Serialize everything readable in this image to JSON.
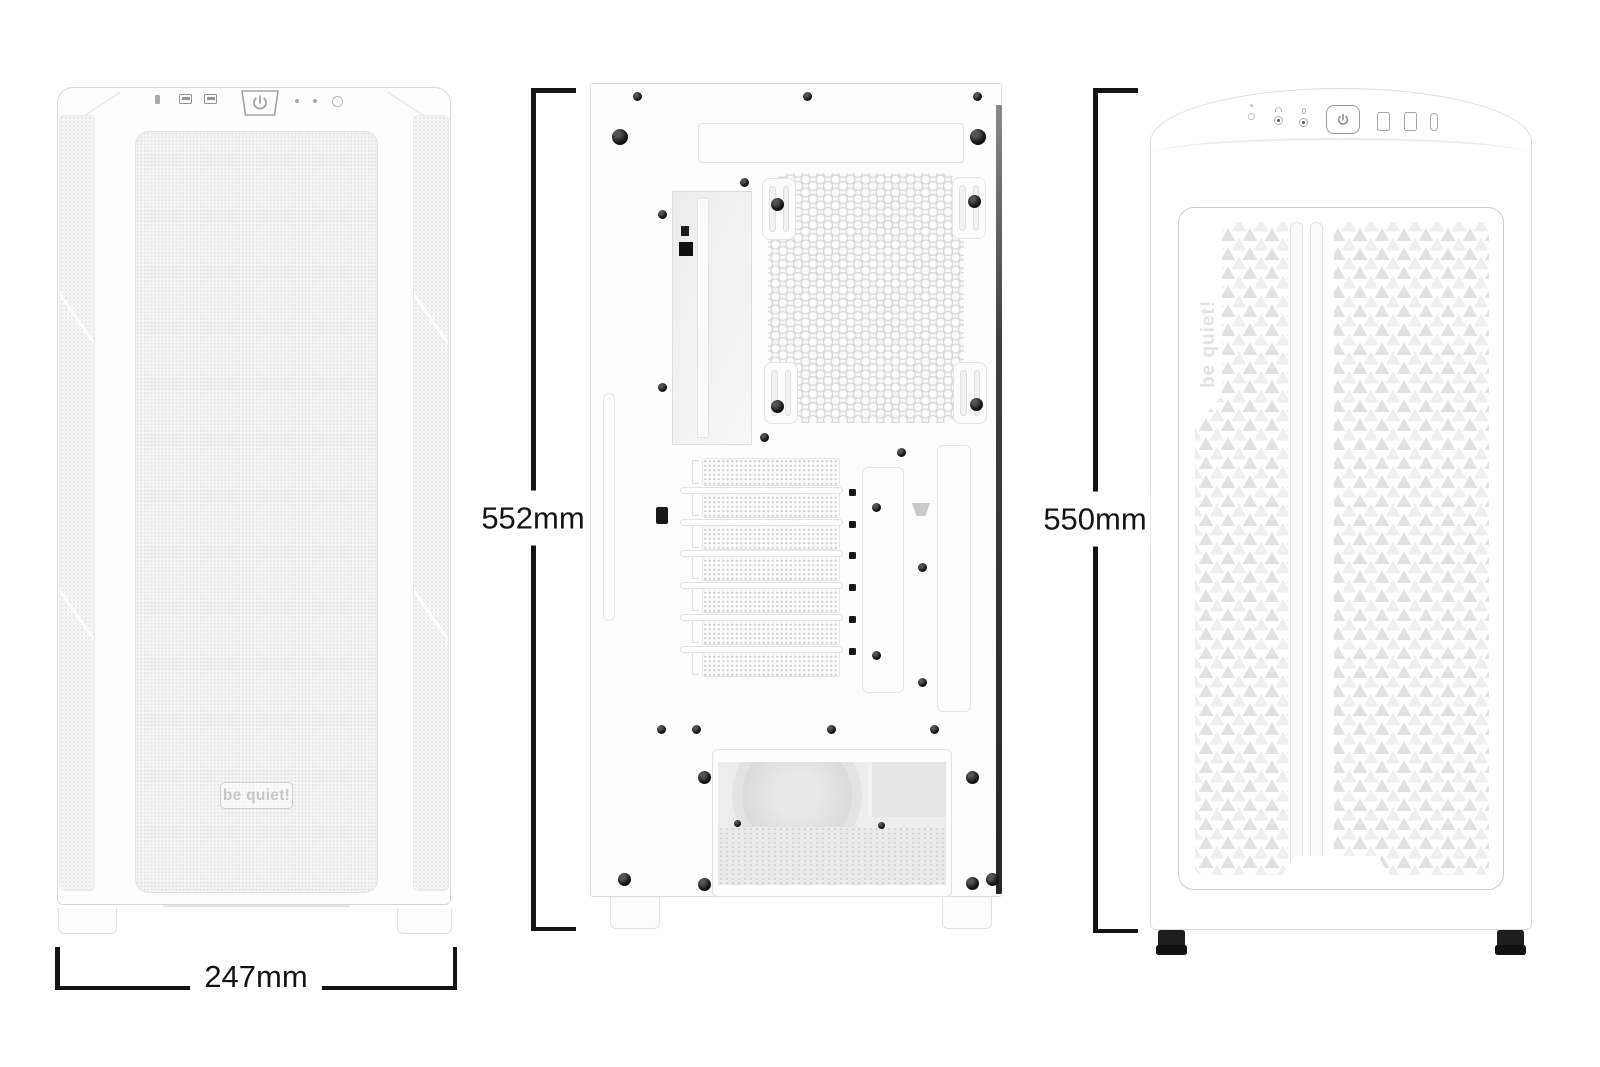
{
  "image_type": "product dimension diagram",
  "product": "white ATX PC case, three orthographic views",
  "brand": "be quiet!",
  "annotation_color": "#141414",
  "views": {
    "front": {
      "title": "front view",
      "dimension": {
        "label": "247mm"
      },
      "logo_text": "be quiet!",
      "io_ports": [
        "audio-jack",
        "usb-a",
        "usb-a",
        "power-button",
        "led",
        "led",
        "reset-button"
      ]
    },
    "rear": {
      "title": "rear view",
      "dimension": {
        "label": "552mm"
      }
    },
    "front_mesh": {
      "title": "front mesh view",
      "dimension": {
        "label": "550mm"
      },
      "side_logo_text": "be quiet!",
      "io_ports": [
        "led",
        "headphone-jack",
        "mic-jack",
        "power-button",
        "usb-a",
        "usb-a",
        "usb-c"
      ]
    }
  }
}
